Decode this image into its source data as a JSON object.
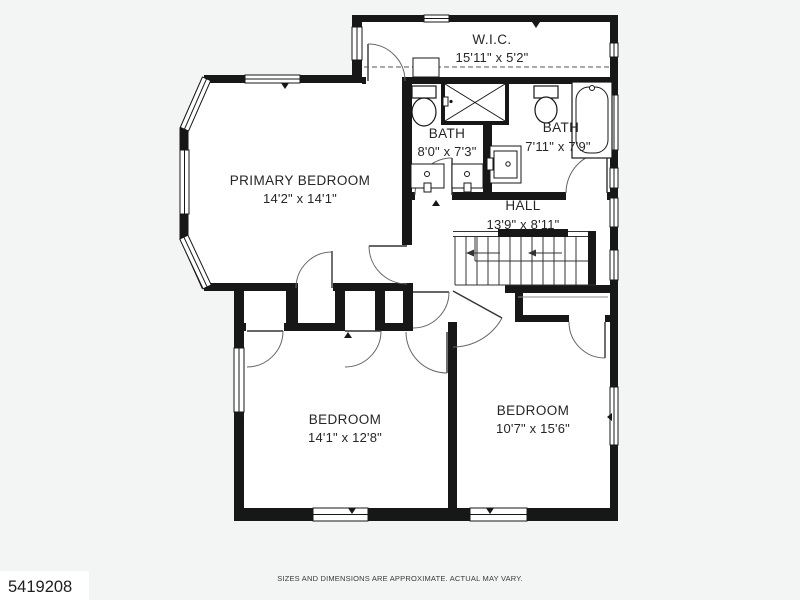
{
  "page": {
    "footer_note": "SIZES AND DIMENSIONS ARE APPROXIMATE. ACTUAL MAY VARY.",
    "watermark_id": "5419208",
    "background": "#f3f4f4"
  },
  "floorplan": {
    "type": "second-floor-plan",
    "colors": {
      "wall": "#171717",
      "floor": "#ffffff",
      "label": "#262626",
      "thin_line": "#555555"
    },
    "rooms": [
      {
        "name": "W.I.C.",
        "dims": "15'11\" x 5'2\""
      },
      {
        "name": "BATH",
        "dims": "8'0\" x 7'3\""
      },
      {
        "name": "BATH",
        "dims": "7'11\" x 7'9\""
      },
      {
        "name": "PRIMARY BEDROOM",
        "dims": "14'2\" x 14'1\""
      },
      {
        "name": "HALL",
        "dims": "13'9\" x 8'11\""
      },
      {
        "name": "BEDROOM",
        "dims": "14'1\" x 12'8\""
      },
      {
        "name": "BEDROOM",
        "dims": "10'7\" x 15'6\""
      }
    ],
    "fixtures": [
      "toilet",
      "shower",
      "double-vanity",
      "vanity",
      "bathtub",
      "stairs",
      "closet-rod"
    ]
  }
}
